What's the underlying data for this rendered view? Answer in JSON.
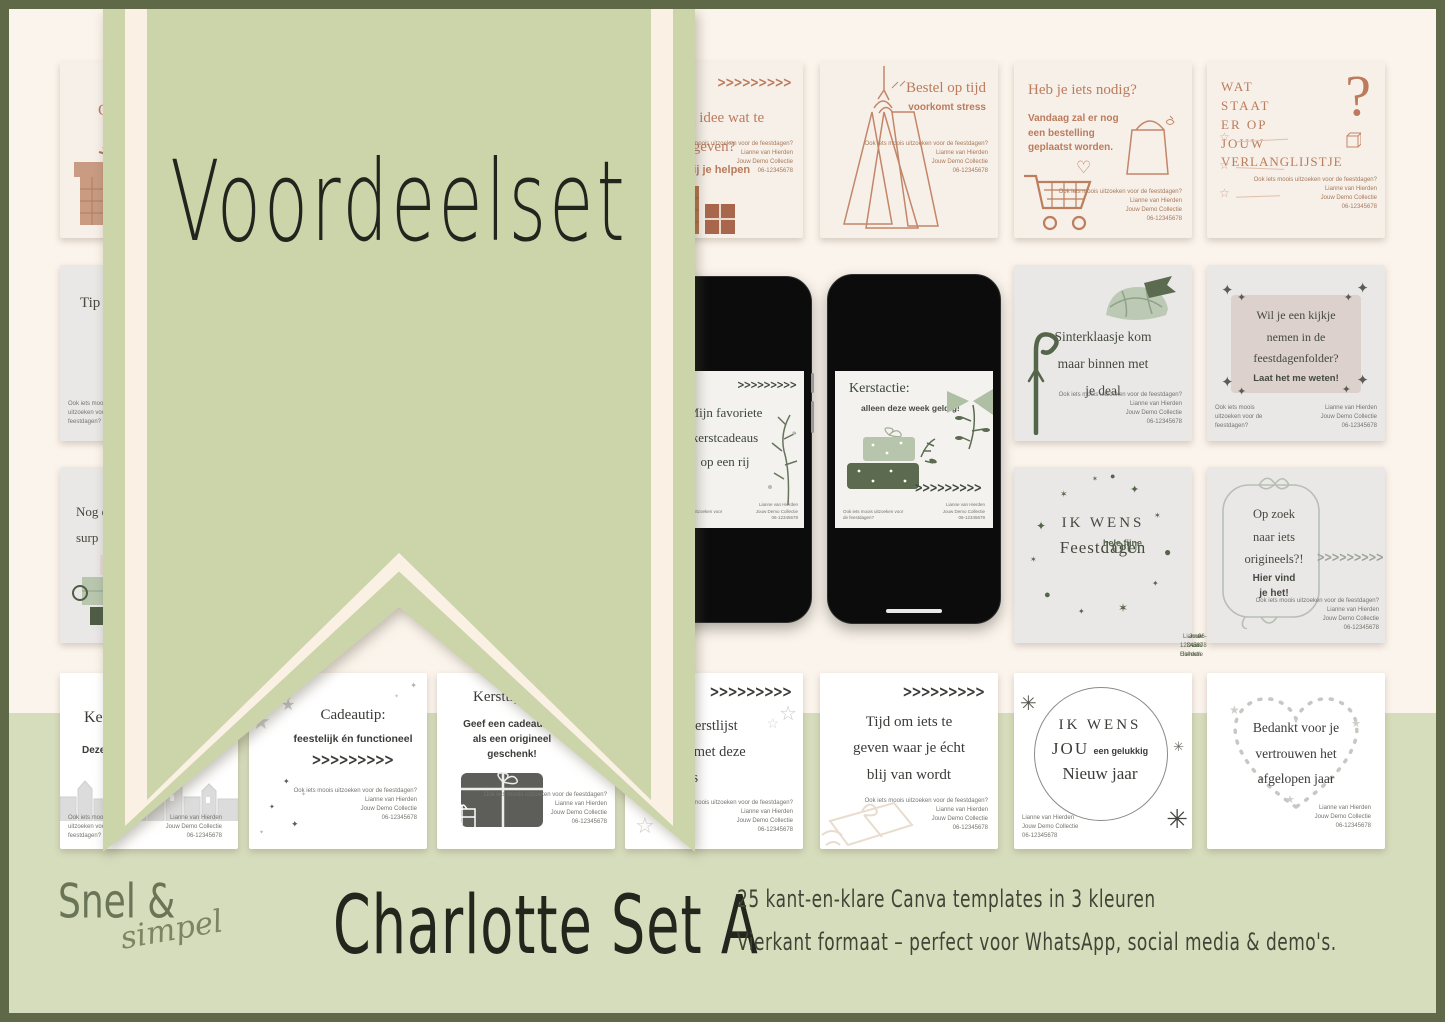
{
  "colors": {
    "cream": "#FBF4EC",
    "band": "#D6DDBC",
    "banner": "#CBD5A9",
    "stripe": "#FAF1E4",
    "frame": "#5F6847",
    "terra": "#BC7B5C",
    "olive": "#5A6B50",
    "sage": "#BCC9B4",
    "pink": "#DCD1CC",
    "cardgray": "#EAE8E6",
    "beige": "#F6F0E9"
  },
  "icons": {
    "chevrons": ">>>>>>>>>",
    "sparkle": "✦",
    "star": "✶",
    "star_outline": "☆",
    "star_solid": "★",
    "dot": "●",
    "heart_outline": "♡",
    "question_mark": "?",
    "asterisk": "✳"
  },
  "banner": {
    "title": "Voordeelset"
  },
  "contact": {
    "question": "Ook iets moois uitzoeken voor de feestdagen?",
    "name": "Lianne van Hierden",
    "company": "Jouw Demo Collectie",
    "phone": "06-12345678"
  },
  "cards": {
    "r1c1": {
      "title_fragment": "C"
    },
    "r1c4": {
      "title_line1": "Geen idee wat te",
      "title_line2": "geven?",
      "subtitle": "Laat mij je helpen"
    },
    "r1c5": {
      "title": "Bestel op tijd",
      "subtitle": "voorkomt stress"
    },
    "r1c6": {
      "title": "Heb je iets nodig?",
      "body_line1": "Vandaag zal er nog",
      "body_line2": "een bestelling",
      "body_line3": "geplaatst worden."
    },
    "r1c7": {
      "title_line1": "WAT",
      "title_line2": "STAAT",
      "title_line3": "ER OP",
      "title_line4": "JOUW",
      "title_line5": "VERLANGLIJSTJE"
    },
    "r2c1": {
      "title_fragment": "Tip"
    },
    "r2c6": {
      "title_line1": "Sinterklaasje kom",
      "title_line2": "maar binnen met",
      "title_line3": "je deal"
    },
    "r2c7": {
      "title_line1": "Wil je een kijkje",
      "title_line2": "nemen in de",
      "title_line3": "feestdagenfolder?",
      "subtitle": "Laat het me weten!"
    },
    "r3c1": {
      "line1": "Nog e",
      "line2": "surp"
    },
    "r3c6": {
      "big1": "IK WENS",
      "big2": "JOU",
      "small2": "hele fijne",
      "big3": "Feestdagen"
    },
    "r3c7": {
      "title_line1": "Op zoek",
      "title_line2": "naar iets",
      "title_line3": "origineels?!",
      "subtitle_line1": "Hier vind",
      "subtitle_line2": "je het!"
    },
    "r4c1": {
      "line1": "Ke",
      "line2": "Deze"
    },
    "r4c2": {
      "title": "Cadeautip:",
      "subtitle": "feestelijk én functioneel"
    },
    "r4c3": {
      "title": "Kersttip:",
      "body_line1": "Geef een cadeaubon",
      "body_line2": "als een origineel",
      "body_line3": "geschenk!"
    },
    "r4c4": {
      "title_line1": "Maak je kerstlijst",
      "title_line2": "compleet met deze",
      "title_line3": "cadeautips"
    },
    "r4c5": {
      "title_line1": "Tijd om iets te",
      "title_line2": "geven waar je écht",
      "title_line3": "blij van wordt"
    },
    "r4c6": {
      "big1": "IK WENS",
      "big2": "JOU",
      "small2": "een gelukkig",
      "big3": "Nieuw jaar"
    },
    "r4c7": {
      "title_line1": "Bedankt voor je",
      "title_line2": "vertrouwen het",
      "title_line3": "afgelopen jaar"
    }
  },
  "phones": {
    "left": {
      "title_line1": "Mijn favoriete",
      "title_line2": "kerstcadeaus",
      "title_line3": "op een rij"
    },
    "right": {
      "title": "Kerstactie:",
      "subtitle": "alleen deze week geldig!"
    }
  },
  "footer": {
    "brand_line1": "Snel &",
    "brand_line2": "simpel",
    "set_title": "Charlotte Set A",
    "desc_line1": "25 kant-en-klare Canva templates in 3 kleuren",
    "desc_line2": "Vierkant formaat – perfect voor WhatsApp, social media & demo's."
  }
}
